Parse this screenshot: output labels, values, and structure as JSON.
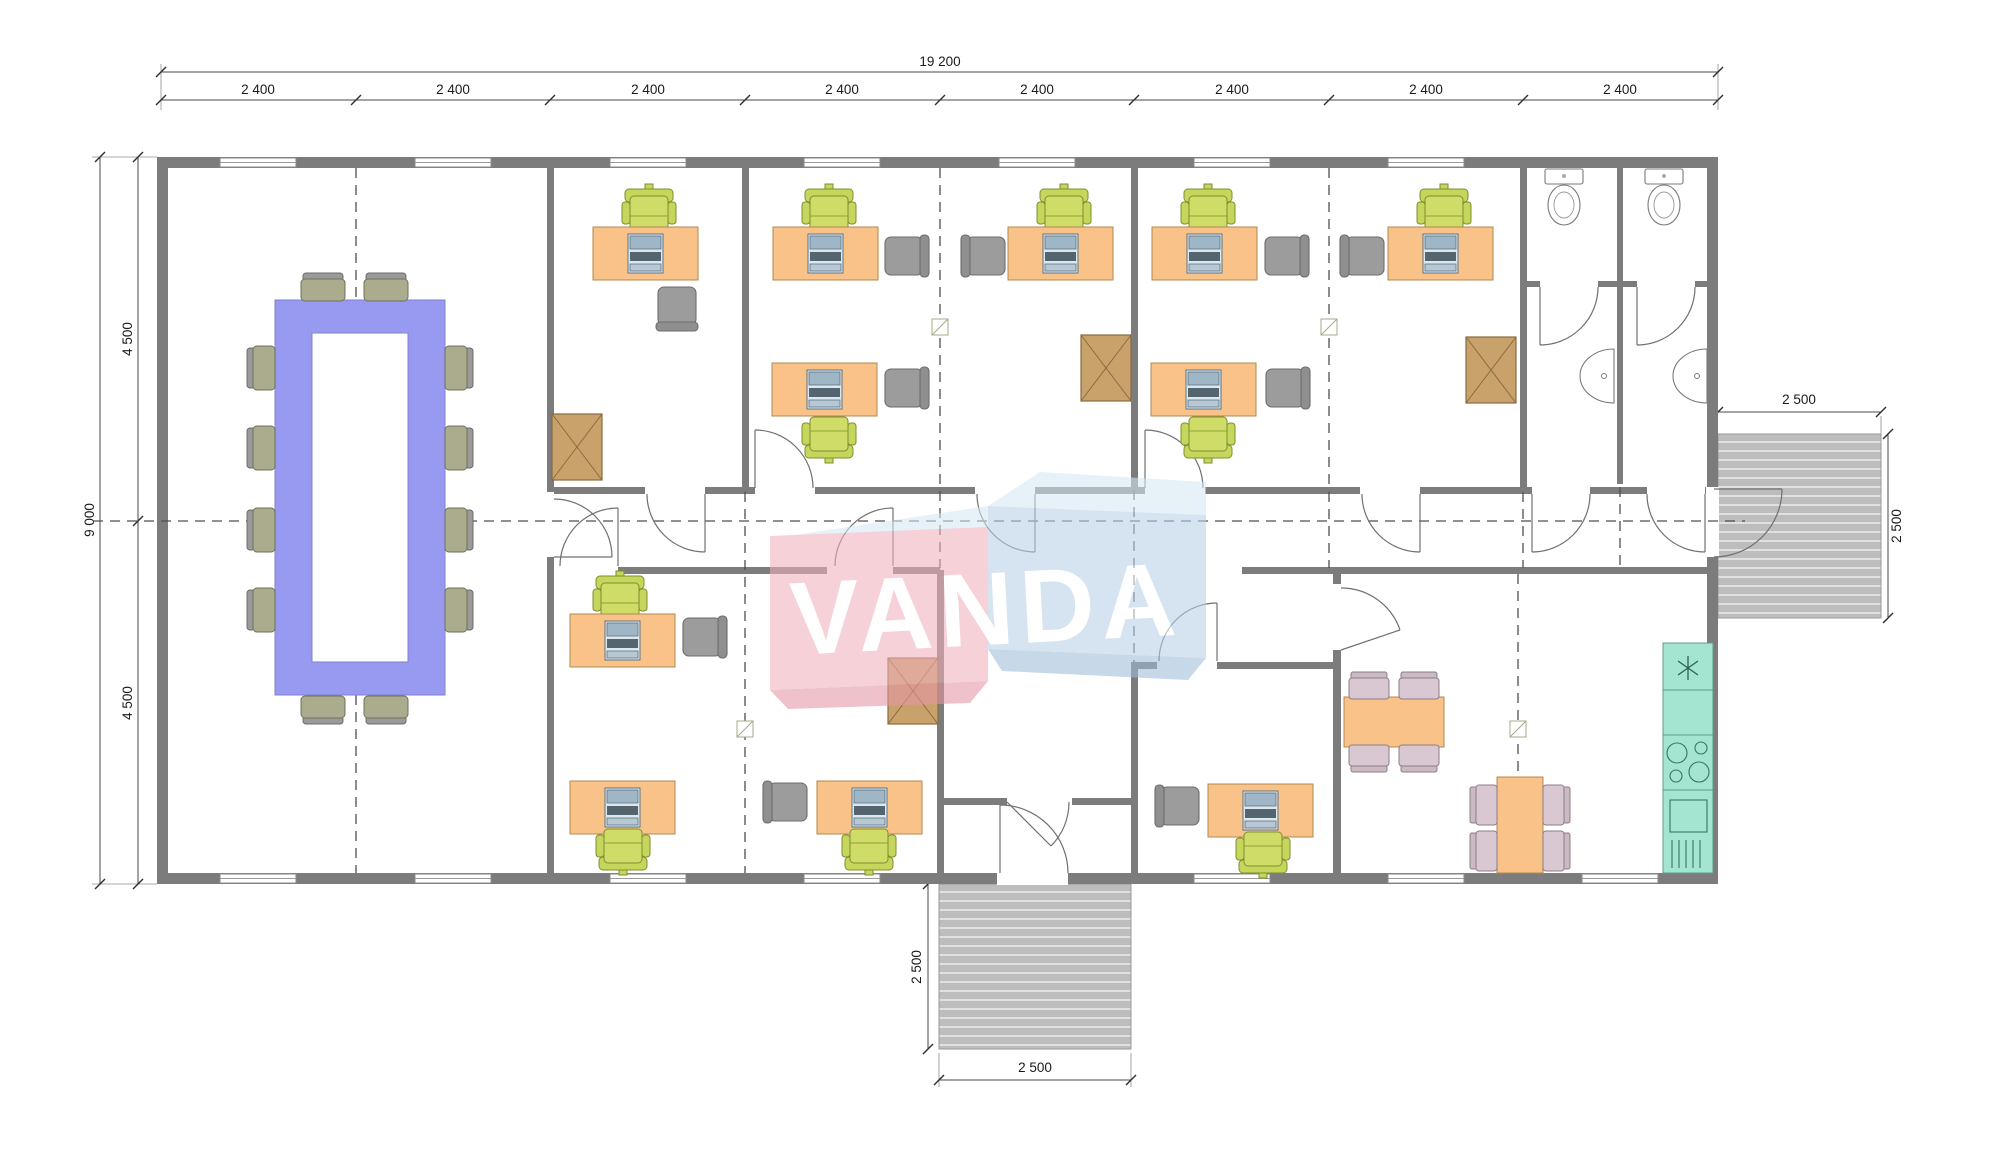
{
  "watermark": {
    "text": "VANDA"
  },
  "dims": {
    "top_total": "19 200",
    "bays": [
      "2 400",
      "2 400",
      "2 400",
      "2 400",
      "2 400",
      "2 400",
      "2 400",
      "2 400"
    ],
    "left_total": "9 000",
    "left_top": "4 500",
    "left_bottom": "4 500",
    "porch_bottom_w": "2 500",
    "porch_bottom_h": "2 500",
    "porch_side_w": "2 500",
    "porch_side_h": "2 500"
  },
  "colors": {
    "wall": "#7c7c7c",
    "dim": "#4a4a4a",
    "text": "#1a1a1a",
    "desk": "#f8c289",
    "deskStroke": "#b28a4e",
    "chairGreen": "#c6d55c",
    "chairGreenDark": "#7f8f2e",
    "chairGray": "#9c9c9c",
    "chairGrayDark": "#6c6c6c",
    "confTable": "#979af0",
    "confTableStroke": "#7f82cc",
    "confChair": "#abab8d",
    "confChairDark": "#70705a",
    "cabinet": "#c9a26b",
    "cabinetStroke": "#8a6b40",
    "counter": "#a3e5d1",
    "counterStroke": "#5f9c8a",
    "dining": "#d9c8d2",
    "diningDark": "#8d7d87",
    "deck": "#bdbdbd",
    "deckLine": "#e9e9e9",
    "wmPink": "#f0b0bd",
    "wmPinkDark": "#e596a6",
    "wmBlue": "#b9d0e8",
    "wmBlueLight": "#d6e7f4",
    "wmBlueDark": "#9fbcd8"
  }
}
